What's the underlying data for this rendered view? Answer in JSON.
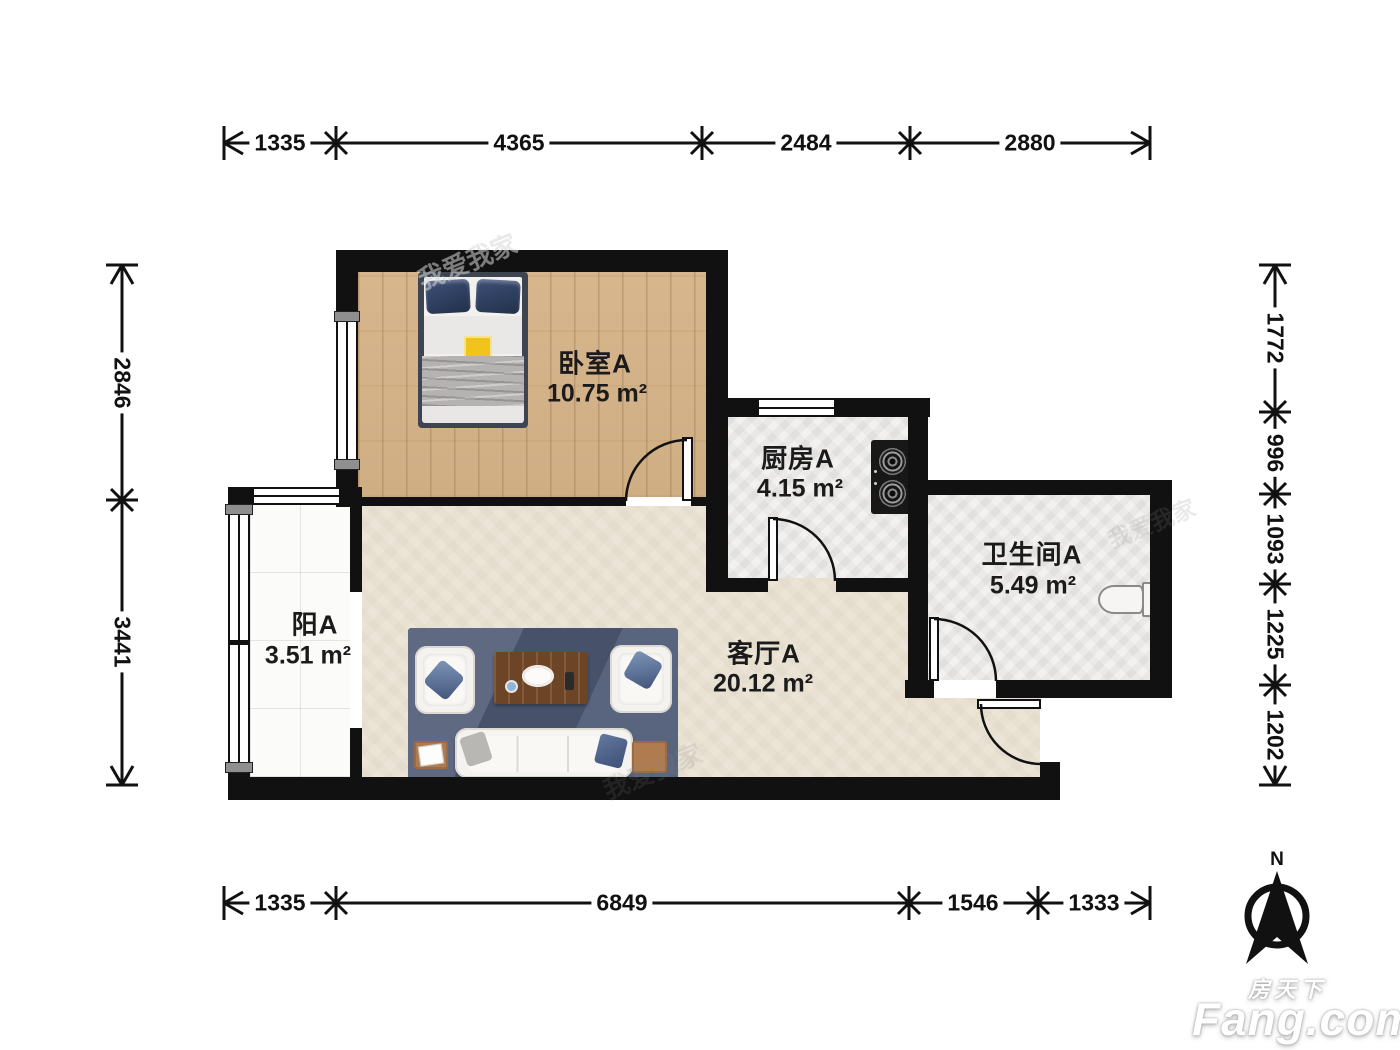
{
  "page": {
    "background": "#ffffff"
  },
  "brand": {
    "name_cn": "房天下",
    "name_en": "Fang.com"
  },
  "compass": {
    "label": "N"
  },
  "rooms": [
    {
      "name": "卧室A",
      "area": "10.75 m²"
    },
    {
      "name": "厨房A",
      "area": "4.15 m²"
    },
    {
      "name": "卫生间A",
      "area": "5.49 m²"
    },
    {
      "name": "客厅A",
      "area": "20.12 m²"
    },
    {
      "name": "阳A",
      "area": "3.51 m²"
    }
  ],
  "dimensions": {
    "top": [
      "1335",
      "4365",
      "2484",
      "2880"
    ],
    "bottom": [
      "1335",
      "6849",
      "1546",
      "1333"
    ],
    "left": [
      "2846",
      "3441"
    ],
    "right": [
      "1772",
      "996",
      "1093",
      "1225",
      "1202"
    ]
  },
  "watermark": {
    "text": "我爱我家"
  },
  "colors": {
    "wall": "#111111",
    "bedroom_floor": "#d7b58c",
    "living_floor": "#ece5d7",
    "kitchen_floor": "#f1f0ee",
    "bathroom_floor": "#f0efed",
    "balcony_floor": "#fafafa",
    "rug": "#4f5b76",
    "sofa": "#f5f3f0",
    "coffee_table": "#6e4426",
    "side_table": "#b07c4f",
    "pillow_navy": "#2c3c5a",
    "stove": "#181818",
    "bed_frame": "#3f4550",
    "blanket_gray": "#b5b3b1",
    "accent_yellow": "#f0c419"
  }
}
